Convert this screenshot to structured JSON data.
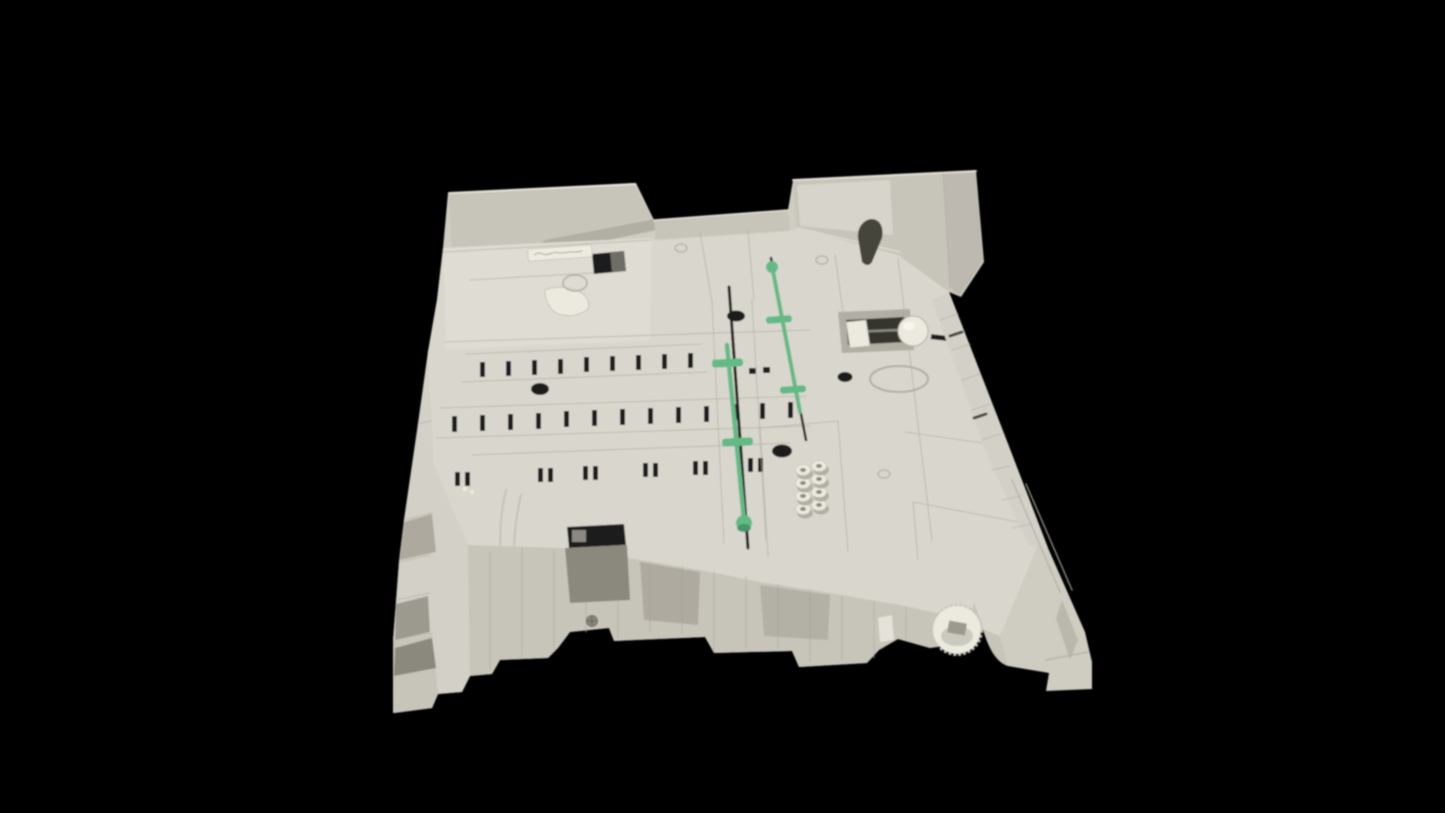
{
  "image": {
    "type": "product-photo",
    "description": "Light gray molded-plastic printer paper tray assembly photographed from the rear underside on a solid black background, showing green paper-guide sliders, rows of molded adjustment slots, a white feed roller mechanism, a cluster of screw bosses, a dark release lever, a corner gear roller and a small white part label sticker with illegible handwriting.",
    "background_color": "#000000"
  },
  "colors": {
    "bg": "#000000",
    "base": "#cfccc2",
    "deck": "#d9d7cd",
    "deckLight": "#e4e2d9",
    "face": "#c7c4ba",
    "faceLight": "#d3d1c7",
    "shadow": "#b1aea4",
    "shadowDeep": "#8b887e",
    "cavity": "#9c998f",
    "slot": "#1f1f1b",
    "green": "#63ba85",
    "greenDark": "#3c8e60",
    "white": "#eceadf",
    "lever": "#45443b",
    "label": "#edebdf",
    "metal": "#8a8880"
  },
  "parts": {
    "tray_body": "molded plastic tray body",
    "rear_left_flange": "rear left wall flange",
    "rear_right_flange": "rear right wall flange",
    "guide_slider_primary": "green paper-guide slider (center)",
    "guide_slider_secondary": "green paper-guide slider (upper right)",
    "comb_slot_rows": "rows of molded guide slots",
    "boss_cluster": "cluster of eight hollow screw bosses",
    "feed_roller": "white feed roller on metal shaft",
    "release_lever": "dark gray release lever",
    "label_sticker": "white part label sticker (handwriting illegible)",
    "corner_roller": "geared corner roller",
    "underside_ribs": "reinforcing ribs on underside edge"
  }
}
